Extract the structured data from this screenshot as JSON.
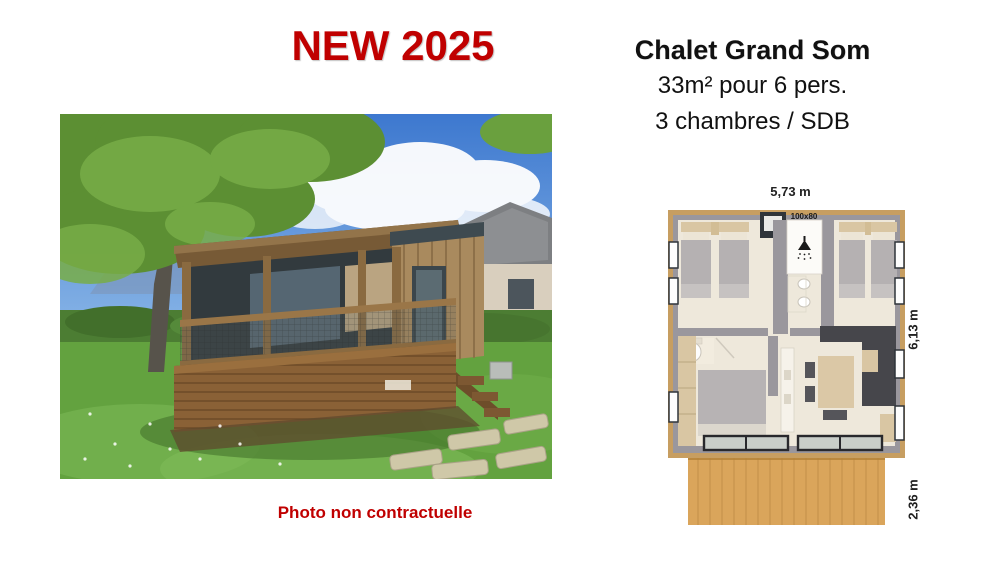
{
  "header": {
    "badge": "NEW 2025",
    "badge_color": "#c00000",
    "title": "Chalet Grand Som",
    "subtitle_area": "33m² pour 6 pers.",
    "subtitle_rooms": "3 chambres / SDB"
  },
  "photo": {
    "caption": "Photo non contractuelle",
    "caption_color": "#c00000",
    "subject": "wooden chalet with covered terrace in a garden"
  },
  "floorplan": {
    "width_label": "5,73 m",
    "depth_label": "6,13 m",
    "terrace_depth_label": "2,36 m",
    "shower_size_label": "100x80",
    "wood_color": "#c79e61",
    "deck_color": "#daa55b",
    "wall_color": "#9a979d",
    "floor_color": "#eee8db"
  }
}
